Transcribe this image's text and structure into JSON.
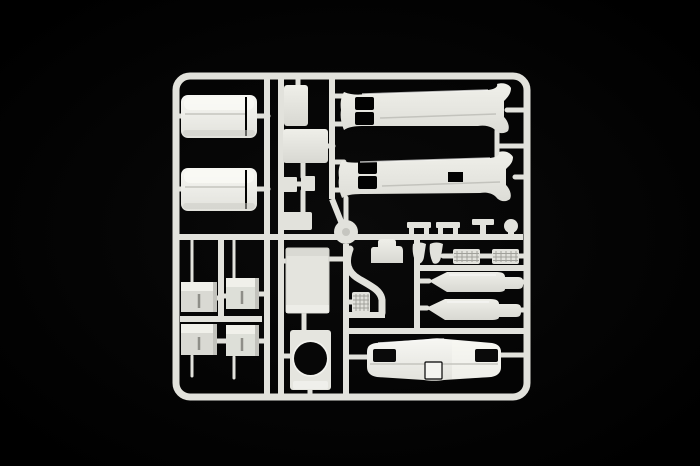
{
  "scene": {
    "type": "product-photograph",
    "subject": "unassembled plastic model kit sprue (parts tree) of a truck kit, white polystyrene on black background",
    "colors": {
      "background": "#020202",
      "plastic": "#e2e2dc",
      "plastic_bright": "#f3f3ef",
      "plastic_dim": "#d6d6d0",
      "plastic_shadow": "#c2c2bc",
      "hole": "#070707"
    }
  },
  "sprue": {
    "frame": {
      "label": "rectangular sprue frame with rounded corners"
    },
    "parts": [
      {
        "id": "rounded-box-1",
        "label": "large rounded body section (upper left)"
      },
      {
        "id": "rounded-box-2",
        "label": "large rounded body section (lower left)"
      },
      {
        "id": "bracket-1",
        "label": "small bracket with pin (row 1 left)"
      },
      {
        "id": "bracket-2",
        "label": "small bracket with pin (row 1 right)"
      },
      {
        "id": "bracket-3",
        "label": "small bracket with pin (row 2 left)"
      },
      {
        "id": "bracket-4",
        "label": "small bracket with pin (row 2 right)"
      },
      {
        "id": "small-rect-vertical",
        "label": "small vertical rectangular panel"
      },
      {
        "id": "small-square",
        "label": "small square panel"
      },
      {
        "id": "clip-pair",
        "label": "pair of small clip pieces"
      },
      {
        "id": "small-rect-horizontal",
        "label": "small horizontal rectangular panel"
      },
      {
        "id": "flat-panel",
        "label": "large flat rectangular panel"
      },
      {
        "id": "round-opening-plate",
        "label": "plate with large circular opening"
      },
      {
        "id": "side-panel-upper",
        "label": "long flared side panel with two window openings (upper)"
      },
      {
        "id": "side-panel-lower",
        "label": "long flared side panel with two window openings (lower)"
      },
      {
        "id": "mirror-arm-1",
        "label": "mirror arm bracket 1"
      },
      {
        "id": "mirror-arm-2",
        "label": "mirror arm bracket 2"
      },
      {
        "id": "t-bracket",
        "label": "small T-shaped bracket"
      },
      {
        "id": "knob",
        "label": "small round knob part"
      },
      {
        "id": "engine-block",
        "label": "small stepped block part"
      },
      {
        "id": "fin-1",
        "label": "small wedge part 1"
      },
      {
        "id": "fin-2",
        "label": "small wedge part 2"
      },
      {
        "id": "grille-step-1",
        "label": "textured grille step 1"
      },
      {
        "id": "grille-step-2",
        "label": "textured grille step 2"
      },
      {
        "id": "air-tank-1",
        "label": "long tapered air tank (upper)"
      },
      {
        "id": "air-tank-2",
        "label": "long tapered air tank (lower)"
      },
      {
        "id": "ribbed-grille",
        "label": "small ribbed grille box"
      },
      {
        "id": "exhaust-pipe",
        "label": "curved exhaust down-pipe"
      },
      {
        "id": "hub-disc",
        "label": "central round sprue hub"
      },
      {
        "id": "front-bumper",
        "label": "truck front bumper with light recesses and licence-plate tab"
      }
    ]
  }
}
